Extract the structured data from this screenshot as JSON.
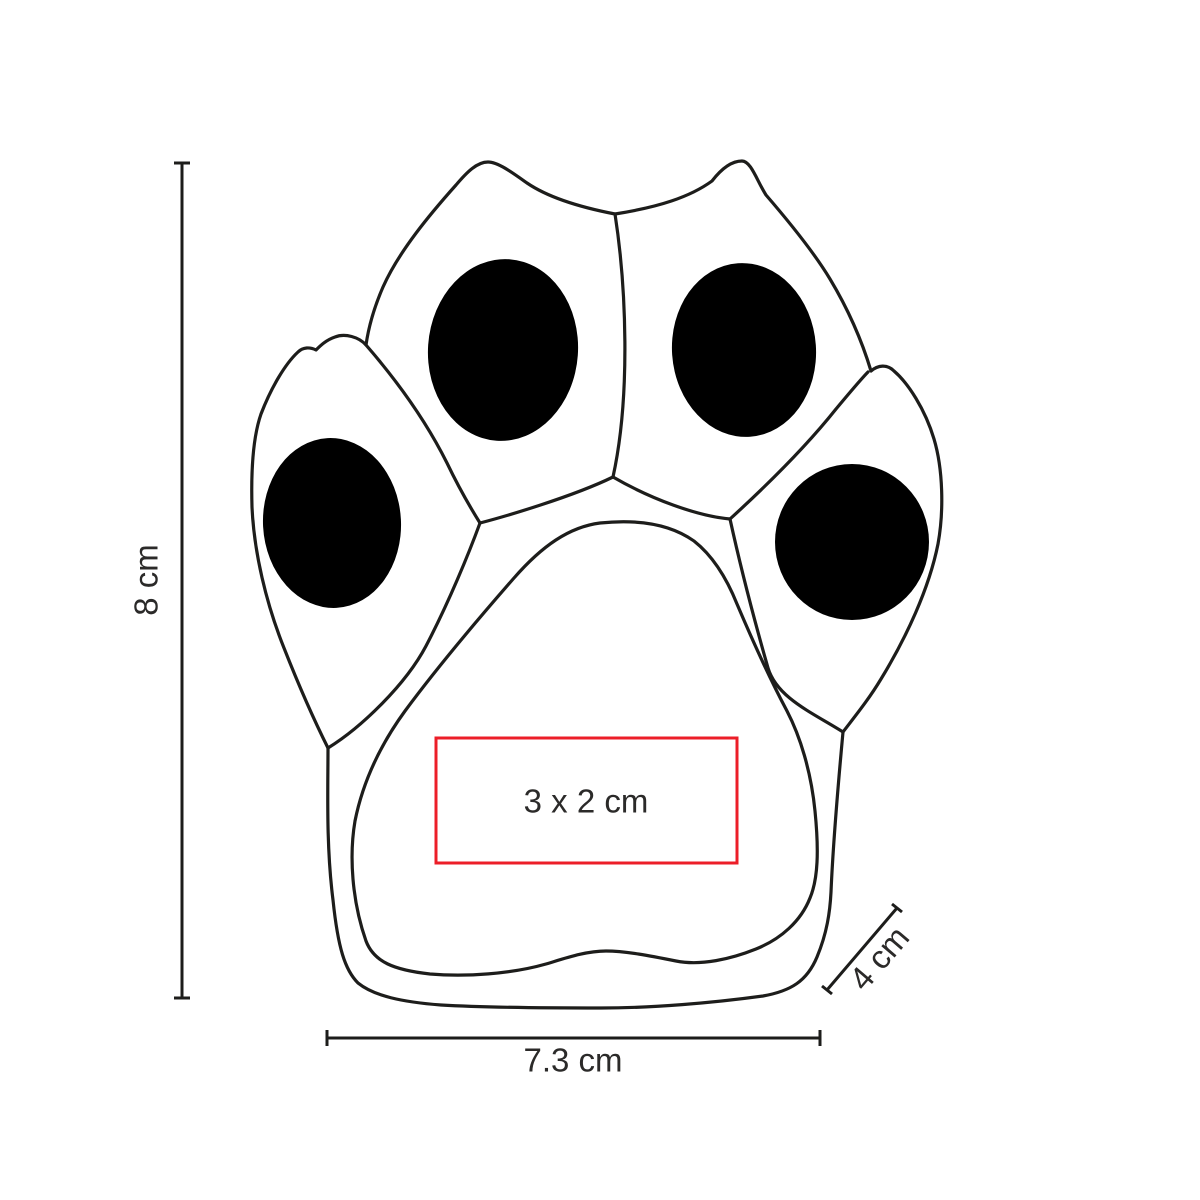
{
  "diagram": {
    "subject_label": "paw-shaped product outline with print-area dimensions"
  },
  "dimensions": {
    "height": {
      "label": "8 cm"
    },
    "width": {
      "label": "7.3 cm"
    },
    "depth": {
      "label": "4 cm"
    }
  },
  "imprint_area": {
    "label": "3 x 2 cm"
  },
  "colors": {
    "accent_red": "#ec1e28",
    "line": "#1d1d1b",
    "pad_fill": "#000000",
    "text": "#2b2a29",
    "background": "#ffffff"
  }
}
